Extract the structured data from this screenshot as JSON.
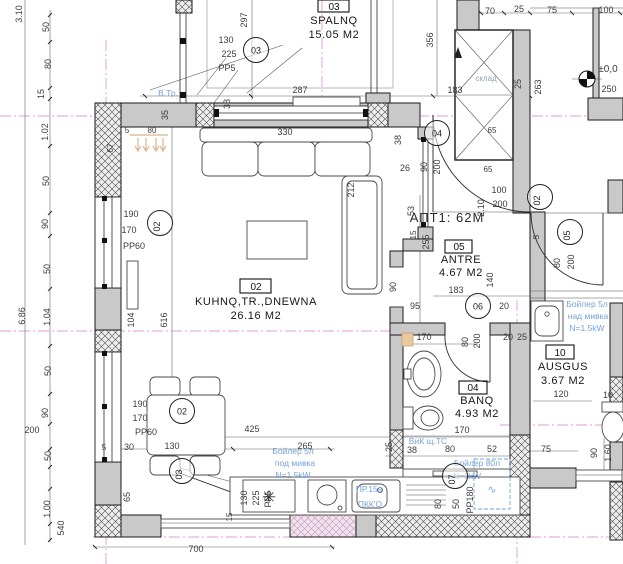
{
  "apartment_label": {
    "t": "АПТ1: 62М",
    "x": 447,
    "y": 222
  },
  "rooms": [
    {
      "id": "spalnq",
      "number": "03",
      "box": [
        318,
        0,
        31,
        12
      ],
      "num_x": 334,
      "num_y": 10,
      "cx": 334,
      "lines": [
        {
          "t": "SPALNQ",
          "y": 24
        },
        {
          "t": "15.05 M2",
          "y": 38
        }
      ]
    },
    {
      "id": "kuhnq",
      "number": "02",
      "box": [
        240,
        279,
        31,
        14
      ],
      "num_x": 256,
      "num_y": 290,
      "cx": 256,
      "lines": [
        {
          "t": "KUHNQ,TR.,DNEWNA",
          "y": 305
        },
        {
          "t": "26.16 M2",
          "y": 319
        }
      ]
    },
    {
      "id": "antre",
      "number": "05",
      "box": [
        445,
        240,
        27,
        13
      ],
      "num_x": 459,
      "num_y": 250,
      "cx": 461,
      "lines": [
        {
          "t": "ANTRE",
          "y": 263
        },
        {
          "t": "4.67 M2",
          "y": 276
        }
      ]
    },
    {
      "id": "banq",
      "number": "04",
      "box": [
        459,
        381,
        28,
        13
      ],
      "num_x": 473,
      "num_y": 391,
      "cx": 477,
      "lines": [
        {
          "t": "BANQ",
          "y": 404
        },
        {
          "t": "4.93 M2",
          "y": 417
        }
      ]
    },
    {
      "id": "ausgus",
      "number": "10",
      "box": [
        546,
        345,
        28,
        14
      ],
      "num_x": 560,
      "num_y": 356,
      "cx": 563,
      "lines": [
        {
          "t": "AUSGUS",
          "y": 370
        },
        {
          "t": "3.67 M2",
          "y": 384
        }
      ]
    }
  ],
  "markers": [
    {
      "n": "03",
      "x": 256,
      "y": 50
    },
    {
      "n": "02",
      "x": 160,
      "y": 223,
      "r": 1
    },
    {
      "n": "02",
      "x": 182,
      "y": 411
    },
    {
      "n": "03",
      "x": 182,
      "y": 471,
      "r": 1
    },
    {
      "n": "04",
      "x": 437,
      "y": 133
    },
    {
      "n": "02",
      "x": 540,
      "y": 197,
      "r": 1
    },
    {
      "n": "05",
      "x": 570,
      "y": 232,
      "r": 1
    },
    {
      "n": "06",
      "x": 478,
      "y": 306
    },
    {
      "n": "07",
      "x": 455,
      "y": 476,
      "r": 1
    }
  ],
  "dimensions": [
    {
      "t": "297",
      "x": 247,
      "y": 20,
      "r": 1
    },
    {
      "t": "3.10",
      "x": 22,
      "y": 14,
      "r": 1
    },
    {
      "t": "50",
      "x": 49,
      "y": 27,
      "r": 1
    },
    {
      "t": "80",
      "x": 51,
      "y": 64,
      "r": 1
    },
    {
      "t": "15",
      "x": 44,
      "y": 94,
      "r": 1
    },
    {
      "t": "1.02",
      "x": 48,
      "y": 132,
      "r": 1
    },
    {
      "t": "50",
      "x": 49,
      "y": 181,
      "r": 1
    },
    {
      "t": "90",
      "x": 48,
      "y": 224,
      "r": 1
    },
    {
      "t": "50",
      "x": 50,
      "y": 269,
      "r": 1
    },
    {
      "t": "6.86",
      "x": 25,
      "y": 316,
      "r": 1
    },
    {
      "t": "1.04",
      "x": 50,
      "y": 317,
      "r": 1
    },
    {
      "t": "50",
      "x": 51,
      "y": 371,
      "r": 1
    },
    {
      "t": "90",
      "x": 48,
      "y": 413,
      "r": 1
    },
    {
      "t": "200",
      "x": 32,
      "y": 433
    },
    {
      "t": "50",
      "x": 51,
      "y": 456,
      "r": 1
    },
    {
      "t": "1.00",
      "x": 50,
      "y": 509,
      "r": 1
    },
    {
      "t": "540",
      "x": 64,
      "y": 528,
      "r": 1
    },
    {
      "t": "130",
      "x": 226,
      "y": 43
    },
    {
      "t": "225",
      "x": 229,
      "y": 57
    },
    {
      "t": "PP5",
      "x": 227,
      "y": 71
    },
    {
      "t": "35",
      "x": 168,
      "y": 115,
      "r": 1
    },
    {
      "t": "38",
      "x": 230,
      "y": 104,
      "r": 1
    },
    {
      "t": "5",
      "x": 127,
      "y": 133,
      "s": 8
    },
    {
      "t": "80",
      "x": 152,
      "y": 133,
      "s": 8
    },
    {
      "t": "67",
      "x": 113,
      "y": 148,
      "r": 1,
      "s": 8
    },
    {
      "t": "287",
      "x": 300,
      "y": 93
    },
    {
      "t": "330",
      "x": 285,
      "y": 135
    },
    {
      "t": "38",
      "x": 401,
      "y": 140,
      "r": 1
    },
    {
      "t": "26",
      "x": 405,
      "y": 171
    },
    {
      "t": "212",
      "x": 354,
      "y": 190,
      "r": 1
    },
    {
      "t": "104",
      "x": 134,
      "y": 320,
      "r": 1
    },
    {
      "t": "616",
      "x": 167,
      "y": 320,
      "r": 1
    },
    {
      "t": "356",
      "x": 433,
      "y": 40,
      "r": 1
    },
    {
      "t": "70",
      "x": 490,
      "y": 14
    },
    {
      "t": "25",
      "x": 519,
      "y": 12
    },
    {
      "t": "75",
      "x": 552,
      "y": 13
    },
    {
      "t": "100",
      "x": 606,
      "y": 13
    },
    {
      "t": "25",
      "x": 521,
      "y": 84,
      "r": 1
    },
    {
      "t": "263",
      "x": 541,
      "y": 87,
      "r": 1
    },
    {
      "t": "183",
      "x": 455,
      "y": 93
    },
    {
      "t": "250",
      "x": 609,
      "y": 92
    },
    {
      "t": "±0,0",
      "x": 608,
      "y": 72,
      "s": 10
    },
    {
      "t": "склад",
      "x": 486,
      "y": 81,
      "s": 8,
      "c": "#93a5b5"
    },
    {
      "t": "90",
      "x": 427,
      "y": 167,
      "r": 1
    },
    {
      "t": "200",
      "x": 440,
      "y": 167,
      "r": 1
    },
    {
      "t": "65",
      "x": 492,
      "y": 133,
      "s": 8
    },
    {
      "t": "65",
      "x": 488,
      "y": 172,
      "s": 8
    },
    {
      "t": "53",
      "x": 414,
      "y": 211,
      "r": 1
    },
    {
      "t": "255",
      "x": 429,
      "y": 242,
      "r": 1
    },
    {
      "t": "15",
      "x": 416,
      "y": 235,
      "r": 1,
      "s": 8
    },
    {
      "t": "2.10",
      "x": 484,
      "y": 208,
      "r": 1
    },
    {
      "t": "100",
      "x": 499,
      "y": 193
    },
    {
      "t": "200",
      "x": 500,
      "y": 207
    },
    {
      "t": "90",
      "x": 396,
      "y": 287,
      "r": 1
    },
    {
      "t": "140",
      "x": 493,
      "y": 280,
      "r": 1
    },
    {
      "t": "183",
      "x": 456,
      "y": 293
    },
    {
      "t": "95",
      "x": 415,
      "y": 309
    },
    {
      "t": "20",
      "x": 504,
      "y": 309
    },
    {
      "t": "80",
      "x": 560,
      "y": 263,
      "r": 1
    },
    {
      "t": "200",
      "x": 574,
      "y": 262,
      "r": 1
    },
    {
      "t": "5",
      "x": 539,
      "y": 237,
      "r": 1,
      "s": 8
    },
    {
      "t": "170",
      "x": 424,
      "y": 340
    },
    {
      "t": "80",
      "x": 468,
      "y": 342,
      "r": 1
    },
    {
      "t": "200",
      "x": 480,
      "y": 341,
      "r": 1
    },
    {
      "t": "20",
      "x": 508,
      "y": 340
    },
    {
      "t": "25",
      "x": 522,
      "y": 340
    },
    {
      "t": "170",
      "x": 462,
      "y": 433
    },
    {
      "t": "25",
      "x": 392,
      "y": 447,
      "r": 1
    },
    {
      "t": "38",
      "x": 412,
      "y": 453
    },
    {
      "t": "80",
      "x": 450,
      "y": 452
    },
    {
      "t": "52",
      "x": 492,
      "y": 452
    },
    {
      "t": "80",
      "x": 441,
      "y": 504,
      "r": 1
    },
    {
      "t": "50",
      "x": 459,
      "y": 504,
      "r": 1
    },
    {
      "t": "PP180",
      "x": 473,
      "y": 500,
      "r": 1
    },
    {
      "t": "120",
      "x": 561,
      "y": 397
    },
    {
      "t": "10",
      "x": 608,
      "y": 398
    },
    {
      "t": "75",
      "x": 546,
      "y": 452
    },
    {
      "t": "90",
      "x": 597,
      "y": 453,
      "r": 1
    },
    {
      "t": "1.60",
      "x": 611,
      "y": 453,
      "r": 1
    },
    {
      "t": "5",
      "x": 104,
      "y": 450,
      "s": 8
    },
    {
      "t": "30",
      "x": 129,
      "y": 450
    },
    {
      "t": "130",
      "x": 172,
      "y": 449
    },
    {
      "t": "425",
      "x": 252,
      "y": 432
    },
    {
      "t": "265",
      "x": 305,
      "y": 449
    },
    {
      "t": "65",
      "x": 130,
      "y": 497,
      "r": 1
    },
    {
      "t": "15",
      "x": 232,
      "y": 517,
      "r": 1,
      "s": 8
    },
    {
      "t": "700",
      "x": 196,
      "y": 552
    },
    {
      "t": "190",
      "x": 140,
      "y": 407
    },
    {
      "t": "170",
      "x": 140,
      "y": 421
    },
    {
      "t": "PP60",
      "x": 146,
      "y": 435
    },
    {
      "t": "190",
      "x": 131,
      "y": 217
    },
    {
      "t": "170",
      "x": 129,
      "y": 233
    },
    {
      "t": "PP60",
      "x": 134,
      "y": 249
    },
    {
      "t": "130",
      "x": 247,
      "y": 498,
      "r": 1
    },
    {
      "t": "225",
      "x": 259,
      "y": 498,
      "r": 1
    },
    {
      "t": "PP5",
      "x": 271,
      "y": 499,
      "r": 1
    }
  ],
  "blue_notes": [
    {
      "t": "В.Тр.",
      "x": 168,
      "y": 96
    },
    {
      "t": "Бойлер 5л",
      "x": 293,
      "y": 454
    },
    {
      "t": "под мивка",
      "x": 295,
      "y": 466
    },
    {
      "t": "N=1.5kW",
      "x": 293,
      "y": 478
    },
    {
      "t": "Бойлер 5л",
      "x": 587,
      "y": 307
    },
    {
      "t": "над мивка",
      "x": 588,
      "y": 319
    },
    {
      "t": "N=1.5kW",
      "x": 587,
      "y": 331
    },
    {
      "t": "Бойлер 80л",
      "x": 477,
      "y": 466
    },
    {
      "t": "N=3kW",
      "x": 467,
      "y": 479
    },
    {
      "t": "ВиК щ.ТС",
      "x": 428,
      "y": 444
    },
    {
      "t": "ПР.15в",
      "x": 369,
      "y": 492
    },
    {
      "t": "ПКК'О",
      "x": 370,
      "y": 507
    }
  ],
  "colors": {
    "axis": "#e29ade",
    "blue_note": "#74a3dc",
    "wall": "#c9c9c9",
    "tan": "#d8b48e"
  }
}
